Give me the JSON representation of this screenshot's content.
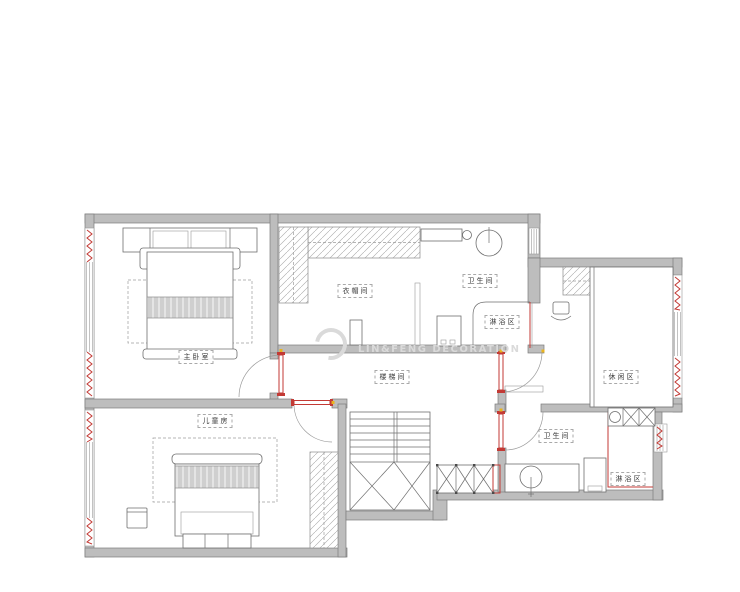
{
  "watermark": {
    "text": "LIN&FENG DECORATION"
  },
  "rooms": [
    {
      "name": "master-bedroom",
      "label": "主卧室"
    },
    {
      "name": "cloakroom",
      "label": "衣帽间"
    },
    {
      "name": "bathroom-upper",
      "label": "卫生间"
    },
    {
      "name": "shower-upper",
      "label": "淋浴区"
    },
    {
      "name": "stair-hall",
      "label": "楼梯间"
    },
    {
      "name": "leisure-room",
      "label": "休闲区"
    },
    {
      "name": "kids-room",
      "label": "儿童房"
    },
    {
      "name": "bathroom-lower",
      "label": "卫生间"
    },
    {
      "name": "shower-lower",
      "label": "淋浴区"
    }
  ],
  "theme": {
    "bg": "#ffffff",
    "wall-fill": "#bdbdbd",
    "wall-stroke": "#7d7d7d",
    "line": "#6f6f6f",
    "dash": "#9d9d9d",
    "accent-red": "#c33a35",
    "hinge-yellow": "#e9b41f",
    "watermark": "#dadada"
  }
}
